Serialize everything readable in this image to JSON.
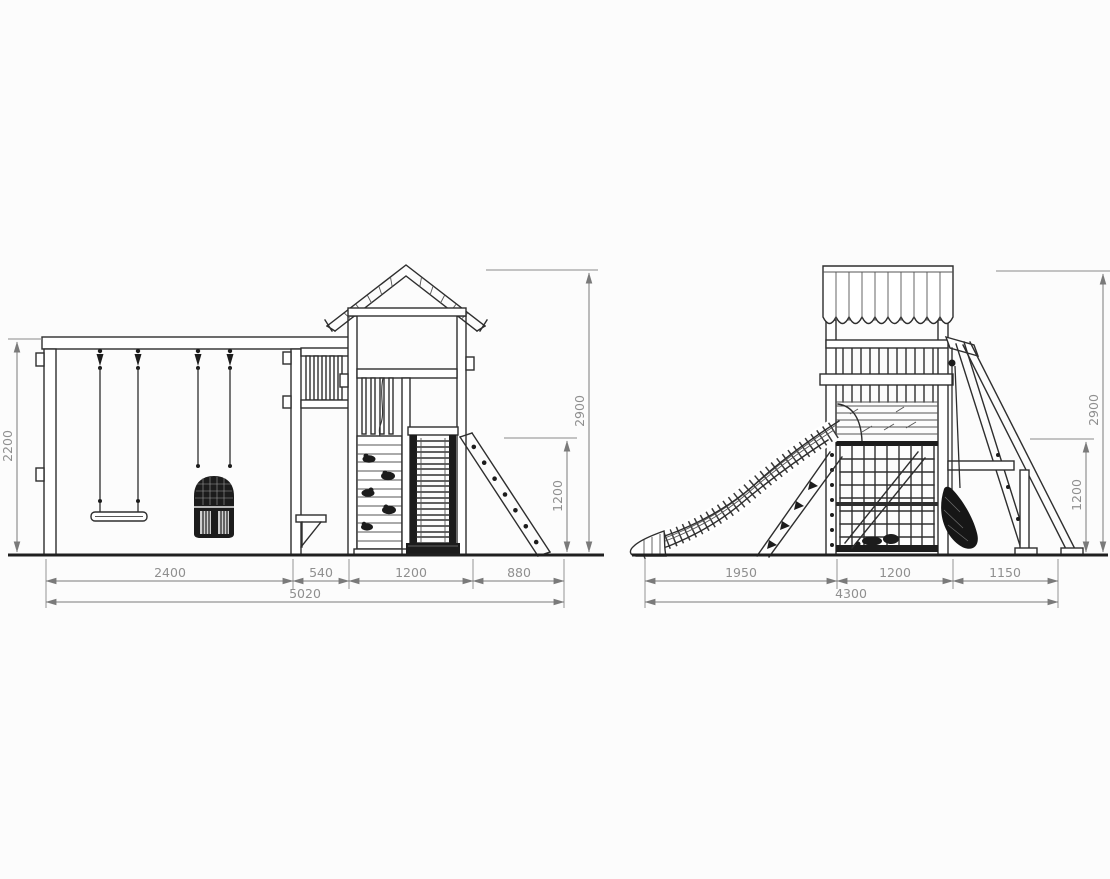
{
  "page": {
    "background_color": "#fcfcfc"
  },
  "drawing": {
    "kind": "technical elevation drawing",
    "subject": "wooden playground set with swings, climbing tower, slide and ladder",
    "stroke_color": "#2e2e2e",
    "dimension_color": "#8f8f8f",
    "views": {
      "front": {
        "name": "front elevation",
        "bottom_dims": [
          "2400",
          "540",
          "1200",
          "880"
        ],
        "bottom_total": "5020",
        "left_height": "2200",
        "overall_height": "2900",
        "ladder_height": "1200"
      },
      "side": {
        "name": "side elevation",
        "bottom_dims": [
          "1950",
          "1200",
          "1150"
        ],
        "bottom_total": "4300",
        "overall_height": "2900",
        "lower_height": "1200"
      }
    }
  }
}
